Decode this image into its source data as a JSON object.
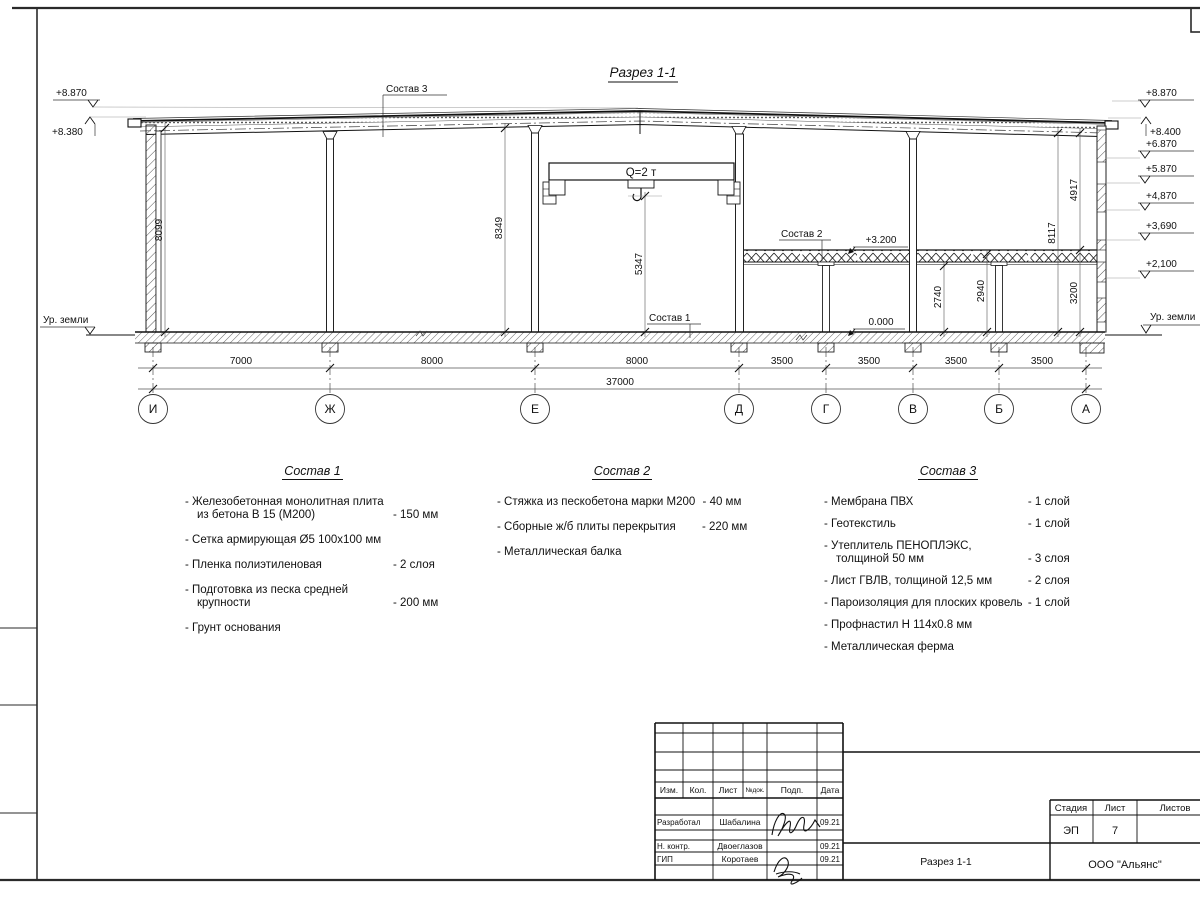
{
  "drawing": {
    "title": "Разрез 1-1",
    "crane": "Q=2 т",
    "ground_label": "Ур. земли",
    "marks_left": [
      "+8.870",
      "+8.380"
    ],
    "marks_right": [
      "+8.870",
      "+8.400",
      "+6.870",
      "+5.870",
      "+4,870",
      "+3,690",
      "+2,100"
    ],
    "mark_slab": "+3.200",
    "mark_floor": "0.000",
    "callouts": [
      "Состав 1",
      "Состав 2",
      "Состав 3"
    ],
    "vdims": {
      "v8099": "8099",
      "v8349": "8349",
      "v5347": "5347",
      "v8117": "8117",
      "v4917": "4917",
      "v3200": "3200",
      "v2740": "2740",
      "v2940": "2940"
    },
    "hdims": [
      "7000",
      "8000",
      "8000",
      "3500",
      "3500",
      "3500",
      "3500"
    ],
    "total": "37000",
    "axes": [
      "И",
      "Ж",
      "Е",
      "Д",
      "Г",
      "В",
      "Б",
      "А"
    ]
  },
  "compositions": [
    {
      "title": "Состав 1",
      "items": [
        {
          "lines": [
            "- Железобетонная  монолитная плита",
            "из бетона В 15 (М200)"
          ],
          "value": "- 150 мм"
        },
        {
          "lines": [
            "- Сетка армирующая Ø5 100х100 мм"
          ],
          "value": ""
        },
        {
          "lines": [
            "- Пленка полиэтиленовая"
          ],
          "value": "- 2 слоя"
        },
        {
          "lines": [
            "- Подготовка из песка средней",
            "крупности"
          ],
          "value": "- 200 мм"
        },
        {
          "lines": [
            "- Грунт основания"
          ],
          "value": ""
        }
      ]
    },
    {
      "title": "Состав 2",
      "items": [
        {
          "lines": [
            "- Стяжка из пескобетона марки М200"
          ],
          "value": "- 40 мм"
        },
        {
          "lines": [
            "- Сборные ж/б плиты перекрытия"
          ],
          "value": "- 220 мм"
        },
        {
          "lines": [
            "- Металлическая балка"
          ],
          "value": ""
        }
      ]
    },
    {
      "title": "Состав 3",
      "items": [
        {
          "lines": [
            "- Мембрана ПВХ"
          ],
          "value": "- 1 слой"
        },
        {
          "lines": [
            "- Геотекстиль"
          ],
          "value": "- 1 слой"
        },
        {
          "lines": [
            "- Утеплитель ПЕНОПЛЭКС,",
            "толщиной 50 мм"
          ],
          "value": "- 3 слоя"
        },
        {
          "lines": [
            "- Лист ГВЛВ, толщиной 12,5 мм"
          ],
          "value": "- 2 слоя"
        },
        {
          "lines": [
            "- Пароизоляция для плоских кровель"
          ],
          "value": "- 1 слой"
        },
        {
          "lines": [
            "- Профнастил Н 114х0.8 мм"
          ],
          "value": ""
        },
        {
          "lines": [
            "- Металлическая ферма"
          ],
          "value": ""
        }
      ]
    }
  ],
  "stamp": {
    "cols": {
      "izm": "Изм.",
      "kol": "Кол.",
      "list": "Лист",
      "ndoc": "№док.",
      "podp": "Подп.",
      "data": "Дата"
    },
    "rows": [
      {
        "role": "Разработал",
        "name": "Шабалина",
        "date": "09.21"
      },
      {
        "role": "Н. контр.",
        "name": "Двоеглазов",
        "date": "09.21"
      },
      {
        "role": "ГИП",
        "name": "Коротаев",
        "date": "09.21"
      }
    ],
    "doc_name": "Разрез 1-1",
    "stage_label": "Стадия",
    "sheet_label": "Лист",
    "sheets_label": "Листов",
    "stage": "ЭП",
    "sheet_no": "7",
    "company": "ООО \"Альянс\""
  }
}
